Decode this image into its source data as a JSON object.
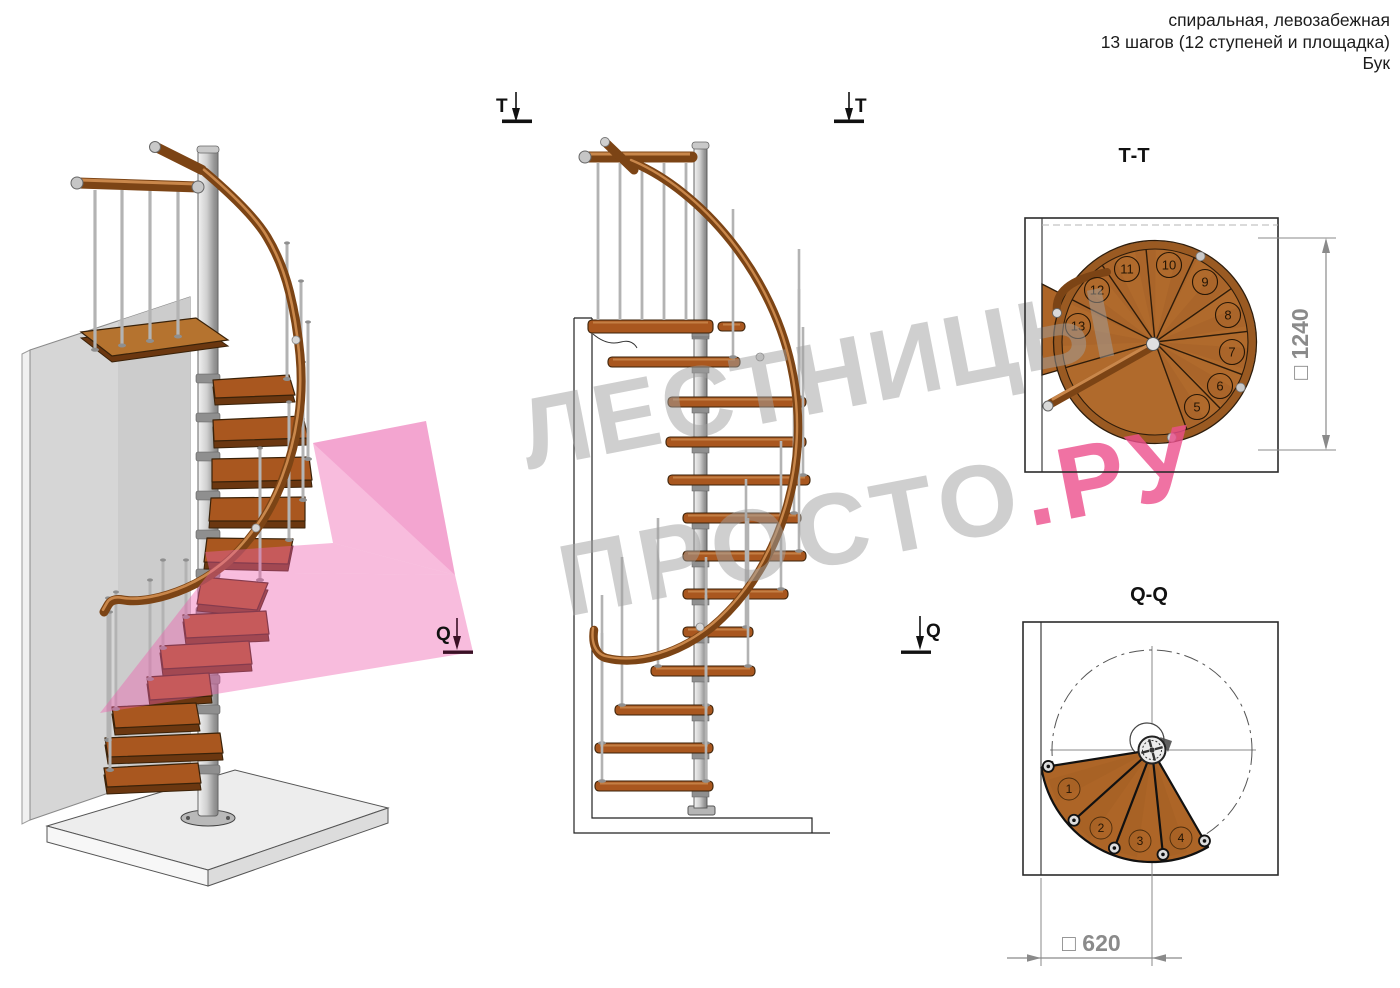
{
  "header": {
    "line1": "спиральная, левозабежная",
    "line2": "13 шагов (12 ступеней и площадка)",
    "line3": "Бук"
  },
  "markers": {
    "t_label": "Т",
    "q_label": "Q"
  },
  "views": {
    "tt": {
      "title": "Т-Т",
      "dimension": "□ 1240",
      "step_numbers": [
        "5",
        "6",
        "7",
        "8",
        "9",
        "10",
        "11",
        "12",
        "13"
      ]
    },
    "qq": {
      "title": "Q-Q",
      "dimension": "□ 620",
      "step_numbers": [
        "1",
        "2",
        "3",
        "4"
      ]
    }
  },
  "watermark": {
    "line1": "ЛЕСТНИЦЫ",
    "line2_gray": "ПРОСТО",
    "line2_pink": ".РУ"
  },
  "colors": {
    "wood": "#a9571f",
    "wood_light": "#b5732f",
    "rail": "#7c4415",
    "metal": "#c8c8c8",
    "wall_gray": "#d6d6d6",
    "watermark_gray": "#9f9f9f",
    "watermark_pink": "#ec4f8c",
    "pink_overlay": "#ee60ae",
    "dim_gray": "#8a8a8a"
  }
}
